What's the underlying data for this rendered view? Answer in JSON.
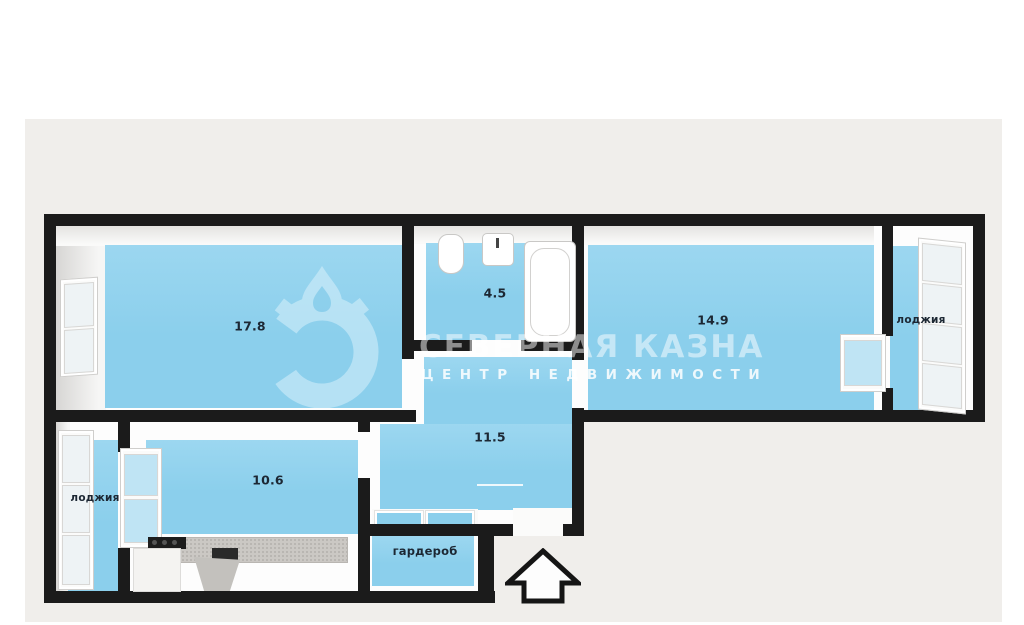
{
  "plan": {
    "rooms": [
      {
        "id": "living-room",
        "label": "17.8"
      },
      {
        "id": "bathroom",
        "label": "4.5"
      },
      {
        "id": "bedroom",
        "label": "14.9"
      },
      {
        "id": "loggia-right",
        "label": "лоджия"
      },
      {
        "id": "hall",
        "label": "11.5"
      },
      {
        "id": "kitchen",
        "label": "10.6"
      },
      {
        "id": "loggia-left",
        "label": "лоджия"
      },
      {
        "id": "wardrobe",
        "label": "гардероб"
      }
    ],
    "fixtures": [
      "toilet",
      "sink",
      "bathtub",
      "kitchen-counter",
      "cooktop",
      "entry-arrow"
    ]
  },
  "watermark": {
    "brand": "СЕВЕРНАЯ КАЗНА",
    "tagline": "ЦЕНТР  НЕДВИЖИМОСТИ"
  },
  "colors": {
    "page": "#ffffff",
    "panel": "#f0eeeb",
    "wall": "#1b1b1b",
    "floor": "#8bcfec",
    "label": "#1c2733"
  }
}
